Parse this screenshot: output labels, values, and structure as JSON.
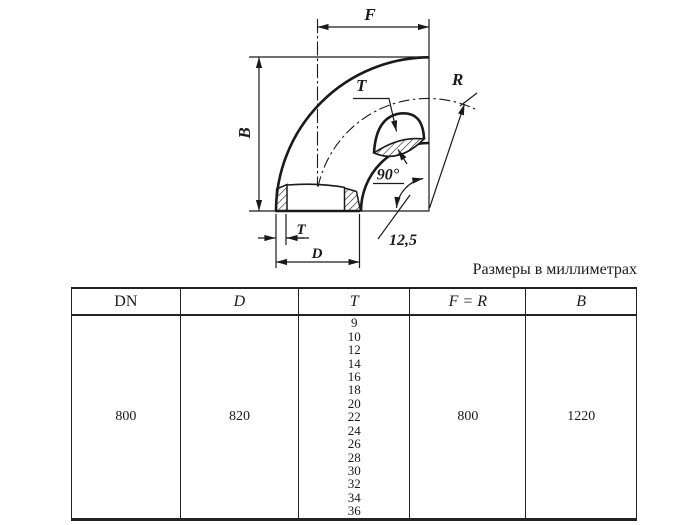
{
  "caption": "Размеры в миллиметрах",
  "drawing": {
    "labels": {
      "f": "F",
      "b": "B",
      "r": "R",
      "t_section": "T",
      "t_bottom": "T",
      "d": "D",
      "angle": "90°",
      "bevel": "12,5"
    }
  },
  "table": {
    "columns": [
      "DN",
      "D",
      "T",
      "F = R",
      "B"
    ],
    "row": {
      "dn": "800",
      "d": "820",
      "t_values": [
        "9",
        "10",
        "12",
        "14",
        "16",
        "18",
        "20",
        "22",
        "24",
        "26",
        "28",
        "30",
        "32",
        "34",
        "36"
      ],
      "f_r": "800",
      "b": "1220"
    }
  },
  "colors": {
    "ink": "#1a1a1a",
    "background": "#ffffff"
  }
}
